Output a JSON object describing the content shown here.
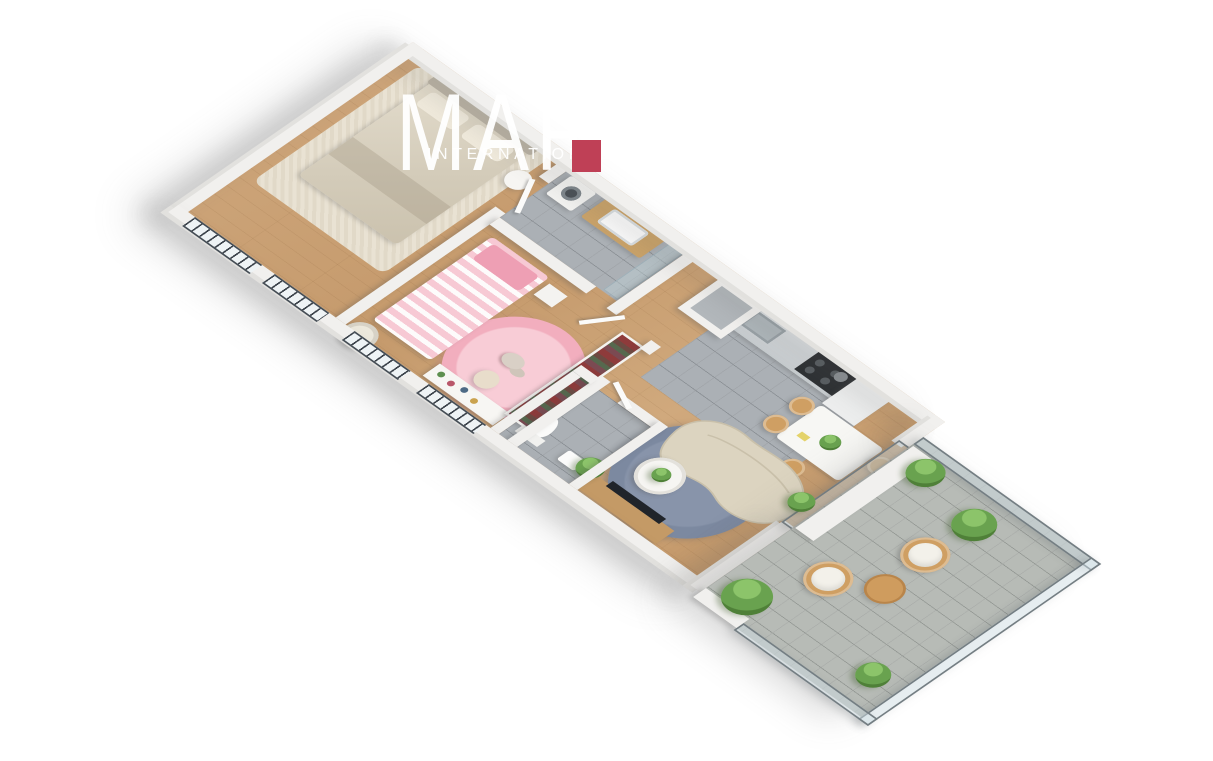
{
  "watermark": {
    "brand": "MARC",
    "subtitle": "INTERNATIONAL",
    "logo": "red-square"
  },
  "palette": {
    "background": "#ffffff",
    "accent_red": "#bf4056",
    "wall": "#f1f0ee",
    "wall_shade": "#dddcd9",
    "wood_floor": "#c9a172",
    "tile": "#abb0b5",
    "paver": "#b7bbb6",
    "glass": "#cfdde3",
    "railing": "#3c434b",
    "pink": "#f2aebe",
    "pink_soft": "#f8ccd6",
    "beige": "#ddd6c4",
    "blue_rug": "#7c89a0",
    "plant": "#69a24f",
    "rattan": "#cf9f63",
    "wood_furniture": "#c49a66",
    "dark_appliance": "#2e3134"
  },
  "scene": {
    "view": "isometric-3d-floorplan",
    "rooms": [
      {
        "name": "master-bedroom",
        "floor": "wood",
        "furniture": [
          "double-bed",
          "area-rug",
          "round-side-table"
        ]
      },
      {
        "name": "kids-bedroom",
        "floor": "wood",
        "furniture": [
          "single-bed",
          "pink-round-rug",
          "teddy-bear",
          "desk",
          "desk-chair",
          "armchair",
          "open-wardrobe",
          "nightstand"
        ]
      },
      {
        "name": "bathroom",
        "floor": "grey-tile",
        "furniture": [
          "washing-machine",
          "vanity-sink",
          "mirror",
          "shower-screen"
        ]
      },
      {
        "name": "toilet",
        "floor": "grey-tile",
        "furniture": [
          "toilet",
          "hand-basin"
        ]
      },
      {
        "name": "kitchen",
        "floor": "grey-tile",
        "furniture": [
          "counter-with-sink",
          "cooktop-oven",
          "tall-cabinet"
        ]
      },
      {
        "name": "hallway",
        "floor": "wood",
        "furniture": [
          "open-doors"
        ]
      },
      {
        "name": "living-dining-room",
        "floor": "wood",
        "furniture": [
          "dining-table",
          "dining-chairs",
          "kidney-sofa",
          "round-blue-rug",
          "coffee-table",
          "tv-unit",
          "potted-plant"
        ]
      },
      {
        "name": "balcony",
        "floor": "stone-pavers",
        "furniture": [
          "rattan-armchairs",
          "round-wood-table",
          "potted-plants",
          "glass-balustrade"
        ]
      }
    ],
    "windows": {
      "style": "french-balcony-railing",
      "count": 4
    }
  }
}
